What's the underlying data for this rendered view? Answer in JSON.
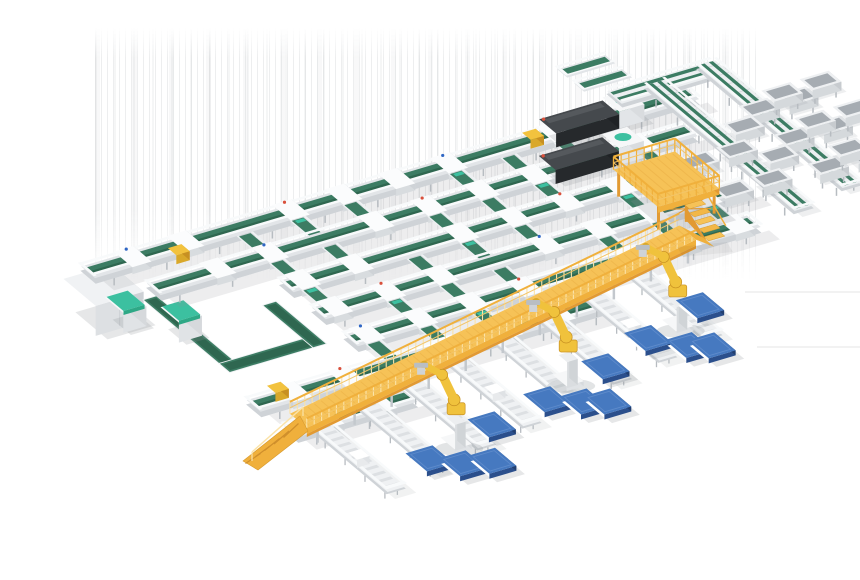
{
  "meta": {
    "description": "3D rendering of an automated parcel sorting and robotic palletizing facility",
    "background": "#ffffff",
    "width": 860,
    "height": 580
  },
  "colors": {
    "belt": "#3c7c63",
    "belt_dark": "#2f6750",
    "belt_edge": "#eef1f3",
    "frame": "#e2e5e8",
    "frame_mid": "#cfd3d7",
    "frame_dark": "#b7bcc1",
    "rail": "#f8fafb",
    "carriage": "#fbfcfd",
    "carriage_side": "#d8dcdf",
    "teal": "#3cc0a0",
    "teal_dark": "#2ea886",
    "yellow_deck": "#f6c257",
    "yellow_mid": "#f0b03c",
    "yellow_side": "#e29a33",
    "yellow_light": "#fbe3a8",
    "robot": "#f0c23c",
    "robot_dark": "#d9a82a",
    "robot_shade": "#c79022",
    "box_white": "#f6f7f8",
    "pallet_top": "#4679c0",
    "pallet_hi": "#5e8bcb",
    "pallet_side": "#2b4f8c",
    "pallet_side2": "#223f70",
    "machine_top": "#45494d",
    "machine_sheen": "#55595d",
    "machine_side": "#26292c",
    "machine_side2": "#1f2225",
    "cabinet_top": "#f0f2f4",
    "cabinet_side": "#dde0e3",
    "cabinet_side2": "#cdd1d5",
    "tray_top": "#eef0f2",
    "tray_inner": "#a6acb2",
    "tray_side": "#d5d9dc",
    "tray_side2": "#c7cbcf",
    "parcel_yellow": "#f2c23e",
    "red": "#d9503c",
    "blue_dot": "#2f66c4",
    "shadow": "rgba(140,146,152,0.22)"
  },
  "projection": {
    "ax": 0.959,
    "ay": -0.284,
    "bx": 0.766,
    "by": 0.643,
    "ox": 90,
    "oy": 268
  },
  "artifact_streaks": {
    "x": 95,
    "y": 28,
    "w": 665,
    "h": 252
  },
  "conveyor_lines": [
    {
      "v": 0,
      "u0": -10,
      "u1": 620
    },
    {
      "v": 42,
      "u0": 25,
      "u1": 585
    },
    {
      "v": 84,
      "u0": 130,
      "u1": 560
    },
    {
      "v": 126,
      "u0": 130,
      "u1": 575
    },
    {
      "v": 168,
      "u0": 130,
      "u1": 550
    },
    {
      "v": 210,
      "u0": -5,
      "u1": 360
    },
    {
      "v": 252,
      "u0": 0,
      "u1": 125
    }
  ],
  "cross_lanes": {
    "u_positions": [
      30,
      85,
      140,
      195,
      250,
      305,
      360,
      415,
      470,
      525
    ]
  },
  "chutes": {
    "u_positions": [
      20,
      75,
      130,
      185,
      240,
      295,
      350,
      405
    ],
    "above": 25,
    "below": 95
  },
  "walkway": {
    "u0": 0,
    "v0": 272,
    "u1": 473,
    "v1": 188,
    "half_width": 11,
    "height": 22
  },
  "platform": {
    "u": 470,
    "v": 95,
    "du": 64,
    "dv": 58,
    "height": 26
  },
  "robots": [
    [
      119,
      329
    ],
    [
      263,
      295
    ],
    [
      398,
      269
    ]
  ],
  "pallets": [
    [
      430,
      258
    ],
    [
      360,
      278
    ],
    [
      385,
      300
    ],
    [
      402,
      308
    ],
    [
      301,
      296
    ],
    [
      226,
      314
    ],
    [
      252,
      329
    ],
    [
      270,
      337
    ],
    [
      160,
      324
    ],
    [
      81,
      342
    ],
    [
      102,
      359
    ],
    [
      127,
      366
    ]
  ],
  "scanners": [
    [
      470,
      0
    ],
    [
      436,
      42
    ]
  ],
  "take_away_lines": [
    {
      "u": 592,
      "v0": -15,
      "v1": 180
    },
    {
      "u": 650,
      "v0": -20,
      "v1": 170
    }
  ],
  "bridge_line": {
    "v": -20,
    "u0": 556,
    "u1": 664
  },
  "stub_conveyors": [
    [
      540,
      -44
    ],
    [
      540,
      -66
    ]
  ],
  "tray_rows": [
    {
      "u": 640,
      "v": 45,
      "count": 2
    },
    {
      "u": 640,
      "v": 90,
      "count": 2
    },
    {
      "u": 640,
      "v": 135,
      "count": 2
    },
    {
      "u": 672,
      "v": 35,
      "count": 2
    },
    {
      "u": 672,
      "v": 78,
      "count": 2
    },
    {
      "u": 672,
      "v": 121,
      "count": 2
    },
    {
      "u": 612,
      "v": 60,
      "count": 1
    },
    {
      "u": 612,
      "v": 105,
      "count": 1
    },
    {
      "u": 545,
      "v": 85,
      "count": 2
    },
    {
      "u": 545,
      "v": 130,
      "count": 2
    }
  ],
  "loop_segments": [
    [
      10,
      58,
      13,
      112
    ],
    [
      10,
      157,
      100,
      13
    ],
    [
      97,
      105,
      13,
      65
    ]
  ],
  "cabinet": {
    "u": -58,
    "v": 38,
    "du": 50,
    "dv": 42,
    "h": 30
  },
  "process_machines": [
    [
      -34,
      62
    ],
    [
      0,
      92
    ]
  ],
  "parcels_yellow": [
    [
      70,
      14
    ],
    [
      449,
      2
    ],
    [
      20,
      206
    ]
  ],
  "faint_lines": [
    [
      745,
      292,
      860,
      292
    ],
    [
      757,
      347,
      860,
      347
    ]
  ],
  "faint_patch": [
    [
      677,
      247
    ],
    [
      727,
      242
    ],
    [
      733,
      252
    ],
    [
      683,
      257
    ]
  ]
}
